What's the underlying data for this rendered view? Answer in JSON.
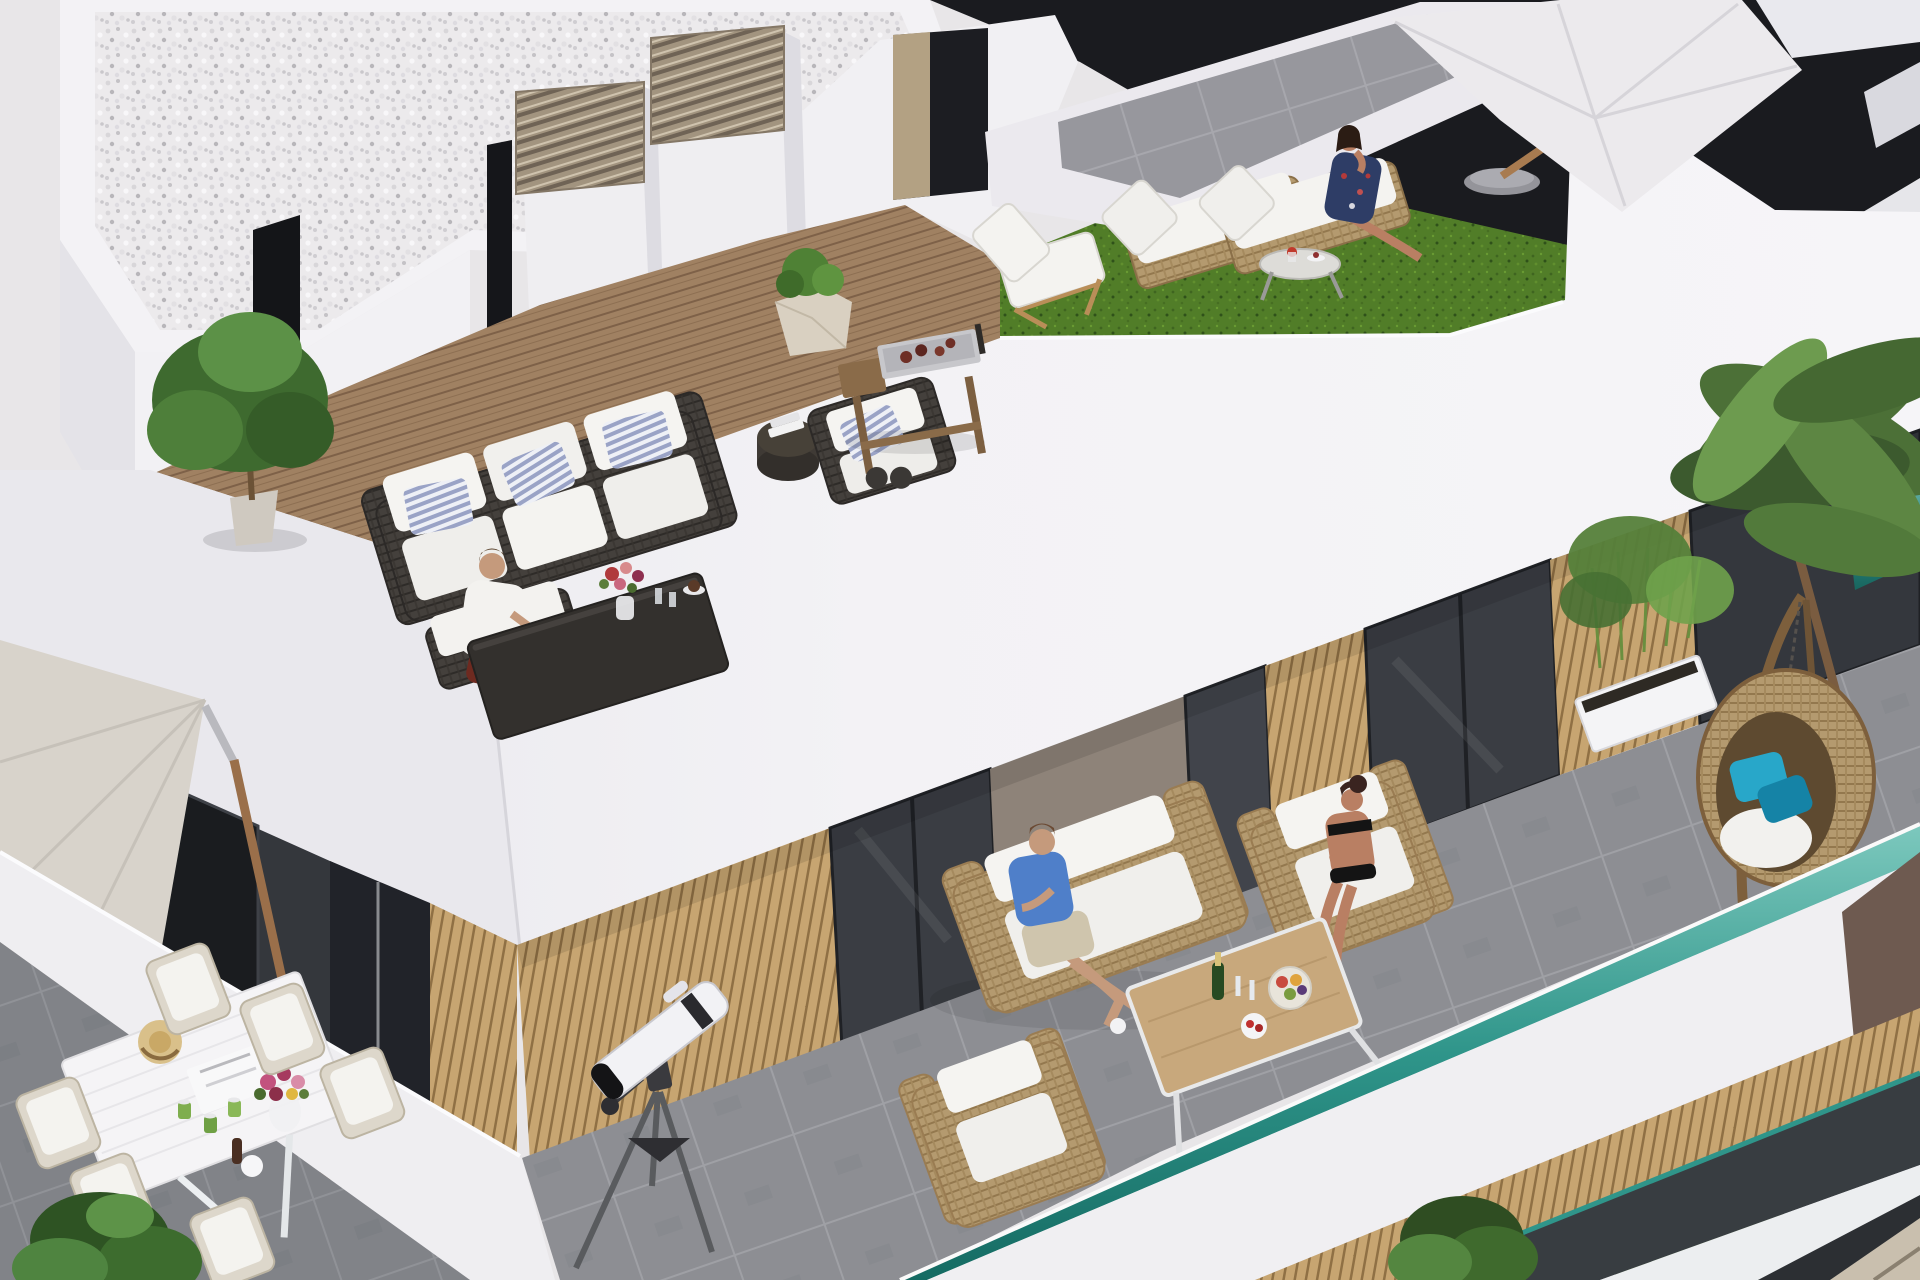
{
  "scene": {
    "type": "3d-architectural-render",
    "description": "Aerial isometric rendering of a modern white penthouse building with stacked rooftop terraces where residents relax",
    "objects": [
      "white-gravel-flat-roof",
      "louvered-vent-chimneys",
      "wood-deck-roof-terrace",
      "dark-rattan-sofa-with-striped-pillows",
      "man-sitting-on-deck",
      "fiddle-leaf-fig-plant",
      "barbecue-cart-with-food",
      "stone-planter",
      "artificial-grass-sun-deck",
      "wooden-low-deck-chair",
      "rattan-sun-loungers",
      "woman-in-floral-dress-on-lounger",
      "round-side-table-with-drinks",
      "white-patio-umbrella",
      "gray-tile-upper-roof",
      "white-fascia-parapet-band",
      "middle-terrace-gray-tiles",
      "glass-sliding-doors",
      "wood-slat-wall-panels",
      "bamboo-planter-box",
      "wire-basket-planters",
      "hanging-egg-chair-with-turquoise-pillows",
      "rattan-loveseat",
      "man-in-blue-tshirt",
      "woman-in-black-bikini-on-armchair",
      "rattan-armchair",
      "wood-coffee-table-with-champagne-and-fruit",
      "white-reflector-telescope-on-tripod",
      "beige-cantilever-parasol",
      "charcoal-wall-with-dark-door",
      "white-dining-table-with-six-chairs",
      "straw-hat-flowers-and-drink-cans",
      "teal-glass-balustrades",
      "neighboring-building-balconies",
      "palm-trees",
      "green-shrub"
    ],
    "people_count": 4
  },
  "palette": {
    "white_wall": "#f3f2f5",
    "white_shaded": "#e9e8ed",
    "white_dark_face": "#dcdbe1",
    "gravel_base": "#eceaec",
    "deck_wood": "#a08162",
    "slat_wood": "#c7a571",
    "tile_gray": "#8d8e93",
    "grass_green": "#517d28",
    "teal_glass": "#2f958a",
    "teal_glass_light": "#7cc8bd",
    "dark_facade": "#1a1b1f",
    "charcoal_wall": "#34373c",
    "glass_dark": "#3a3d43",
    "wicker_dark": "#44403c",
    "wicker_light": "#b49a6f",
    "cushion_white": "#f5f4f1",
    "pillow_stripe_blue": "#9aa3c6",
    "pillow_turquoise": "#28a7c9",
    "skin": "#c59a7c",
    "shirt_blue": "#4f7fc9",
    "shorts_red": "#6e2a20",
    "palm_green": "#4c7037",
    "parasol_beige": "#d8d3cb",
    "umbrella_white": "#eceaed",
    "metal_louver": "#a2947f",
    "stone_pot": "#d9d0c1",
    "table_wood": "#c8a87c",
    "taupe_wall": "#8e8379",
    "brown_wall": "#6e5a50",
    "tan_wall": "#c9bfae"
  }
}
